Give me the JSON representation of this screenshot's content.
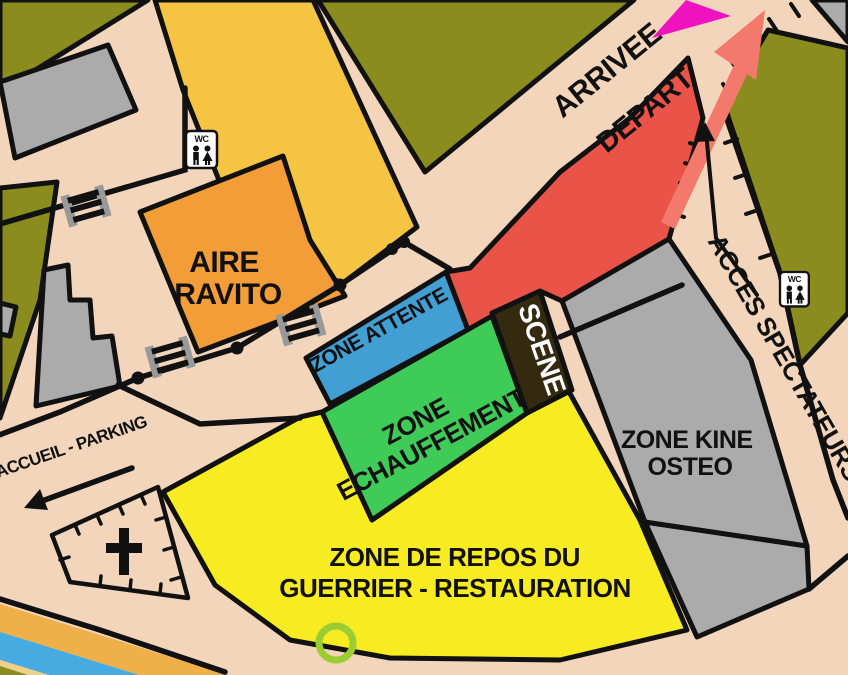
{
  "map": {
    "labels": {
      "arrivee": "ARRIVEE",
      "depart": "DEPART",
      "acces_spectateurs": "ACCES SPECTATEURS",
      "accueil_parking": "ACCUEIL - PARKING",
      "aire_ravito": {
        "line1": "AIRE",
        "line2": "RAVITO"
      },
      "zone_attente": "ZONE ATTENTE",
      "zone_echauffement": {
        "line1": "ZONE",
        "line2": "ECHAUFFEMENT"
      },
      "scene": "SCENE",
      "zone_kine": {
        "line1": "ZONE KINE",
        "line2": "OSTEO"
      },
      "zone_repos": {
        "line1": "ZONE DE REPOS DU",
        "line2": "GUERRIER - RESTAURATION"
      },
      "wc": "WC"
    },
    "colors": {
      "background_olive": "#8A8D1E",
      "path_tan": "#F3D5BB",
      "building_gray": "#ABABAB",
      "building_yellow": "#F6C443",
      "ravito_orange": "#F29D37",
      "depart_red": "#E95348",
      "attente_blue": "#429FD4",
      "echauffement_green": "#3ECB58",
      "scene_dark": "#332A10",
      "repos_yellow": "#F7EB21",
      "arrivee_arrow_magenta": "#EE13BE",
      "depart_arrow_salmon": "#F2796C",
      "river_blue": "#45ABE0",
      "river_bank_yellow": "#EFB04A",
      "start_circle_green": "#9ACD32",
      "outline_black": "#111111"
    }
  }
}
